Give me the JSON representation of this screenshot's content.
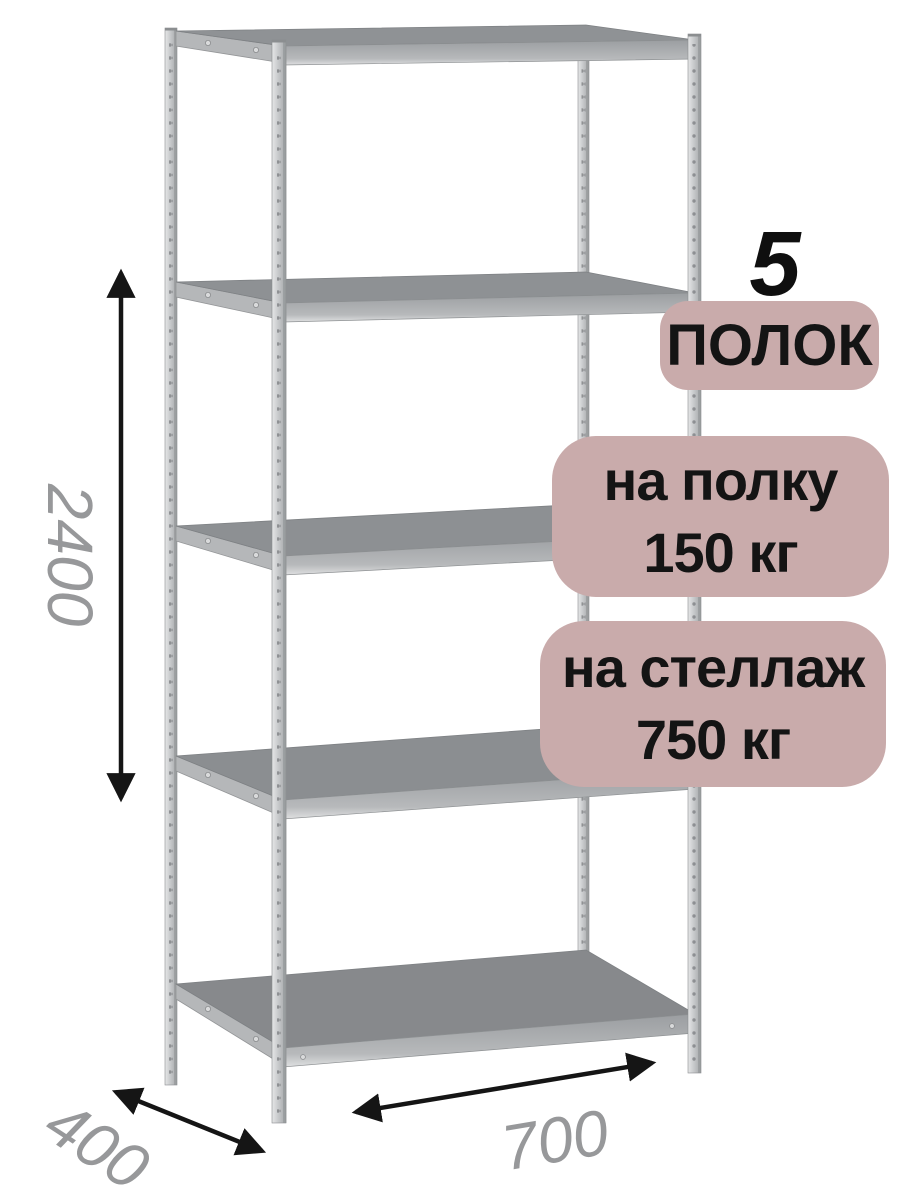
{
  "badges": {
    "count_number": "5",
    "count_label": "ПОЛОК",
    "per_shelf": {
      "line1": "на полку",
      "line2": "150 кг"
    },
    "per_rack": {
      "line1": "на стеллаж",
      "line2": "750 кг"
    },
    "bg_color": "#c9abab",
    "text_color": "#141414"
  },
  "dimensions": {
    "height": "2400",
    "width": "700",
    "depth": "400",
    "label_color": "#97989a",
    "arrow_color": "#151515"
  },
  "rack": {
    "shelf_count": 5,
    "metal_light": "#e3e4e5",
    "metal_mid": "#c6c8ca",
    "metal_dark": "#9fa2a4",
    "shelf_top_color": "#8c8f92",
    "background": "#ffffff"
  }
}
